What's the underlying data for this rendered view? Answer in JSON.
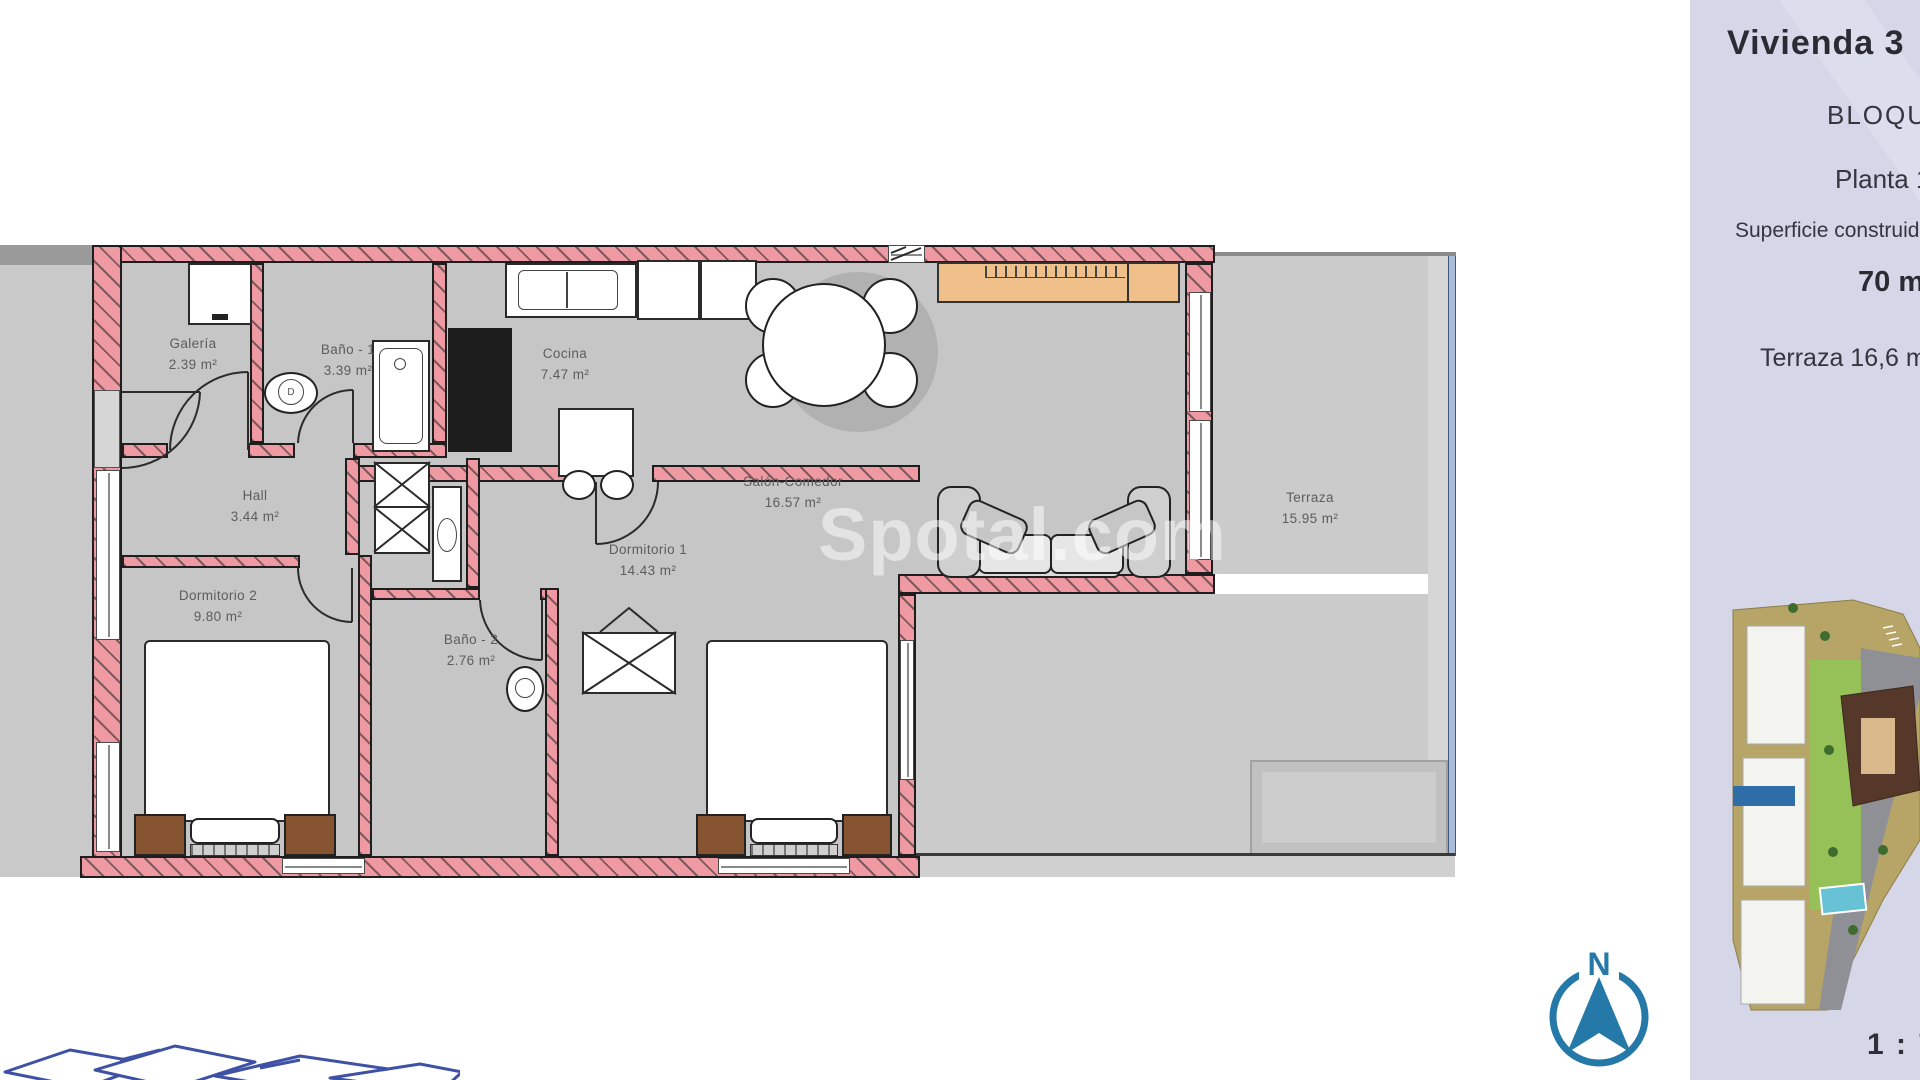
{
  "panel": {
    "title": "Vivienda 3",
    "block": "BLOQUE",
    "planta": "Planta 1",
    "surface_label": "Superficie construida",
    "surface_value": "70 m²",
    "terrace_line": "Terraza 16,6 m²",
    "scale_text": "1 : 75",
    "bg_color": "#d5d7e9"
  },
  "rooms": [
    {
      "name": "Galería",
      "area": "2.39 m²"
    },
    {
      "name": "Baño - 1",
      "area": "3.39 m²"
    },
    {
      "name": "Cocina",
      "area": "7.47 m²"
    },
    {
      "name": "Hall",
      "area": "3.44 m²"
    },
    {
      "name": "Salón-Comedor",
      "area": "16.57 m²"
    },
    {
      "name": "Dormitorio 2",
      "area": "9.80 m²"
    },
    {
      "name": "Dormitorio 1",
      "area": "14.43 m²"
    },
    {
      "name": "Baño - 2",
      "area": "2.76 m²"
    },
    {
      "name": "Terraza",
      "area": "15.95 m²"
    }
  ],
  "compass": {
    "north": "N",
    "color": "#2579a9"
  },
  "watermark": {
    "text": "Spotal.com"
  },
  "site_plan": {
    "highlight_color": "#2e6da8"
  },
  "plan_marks": {
    "bidet_mark": "D"
  },
  "colors": {
    "wall_pink": "#ef9aa2",
    "floor_gray": "#c6c6c6",
    "sideboard_orange": "#efc089",
    "bed_brown": "#875432"
  }
}
